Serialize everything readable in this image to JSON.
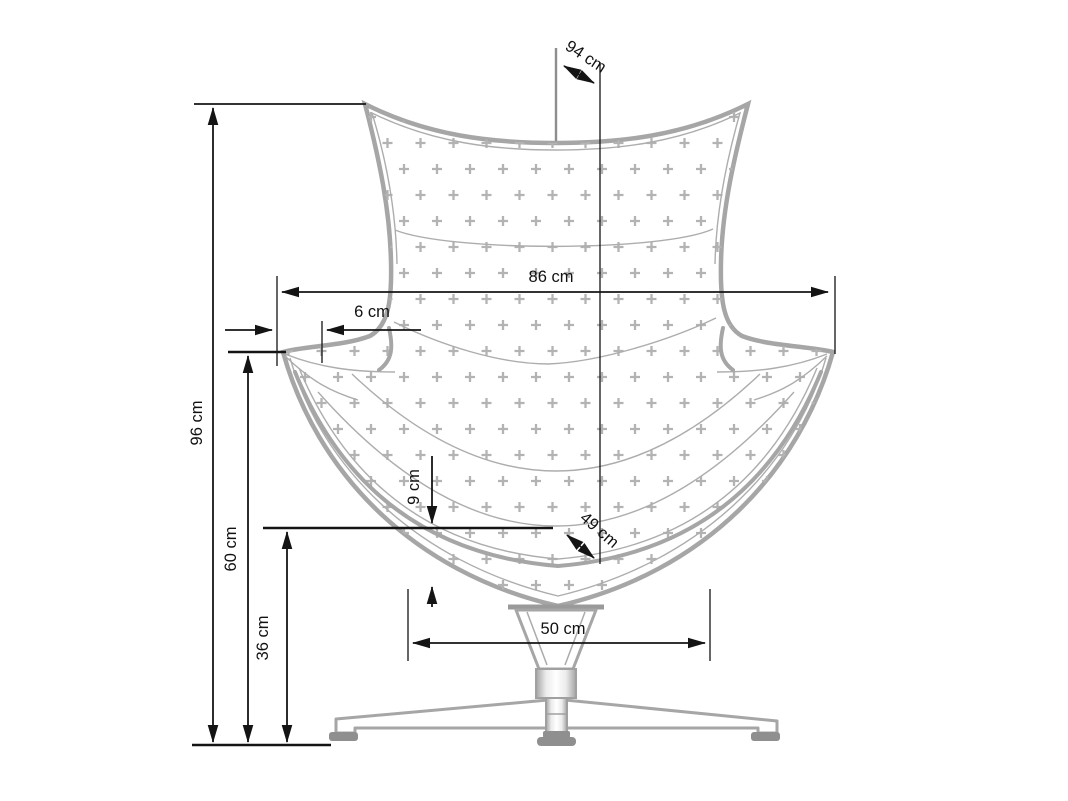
{
  "drawing": {
    "subject": "egg-armchair-front-elevation",
    "units": "cm",
    "dimensions": {
      "depth_overall": {
        "label": "94 cm",
        "value_cm": 94
      },
      "width_overall": {
        "label": "86 cm",
        "value_cm": 86
      },
      "arm_inset": {
        "label": "6 cm",
        "value_cm": 6
      },
      "height_overall": {
        "label": "96 cm",
        "value_cm": 96
      },
      "armrest_height": {
        "label": "60 cm",
        "value_cm": 60
      },
      "seat_height": {
        "label": "36 cm",
        "value_cm": 36
      },
      "cushion_drop": {
        "label": "9 cm",
        "value_cm": 9
      },
      "seat_depth": {
        "label": "49 cm",
        "value_cm": 49
      },
      "base_width": {
        "label": "50 cm",
        "value_cm": 50
      }
    },
    "colors": {
      "background": "#ffffff",
      "chair_outline": "#a6a6a6",
      "quilting_pattern": "#b3b3b3",
      "dimension_lines": "#141414",
      "feet": "#8f8f8f"
    }
  }
}
